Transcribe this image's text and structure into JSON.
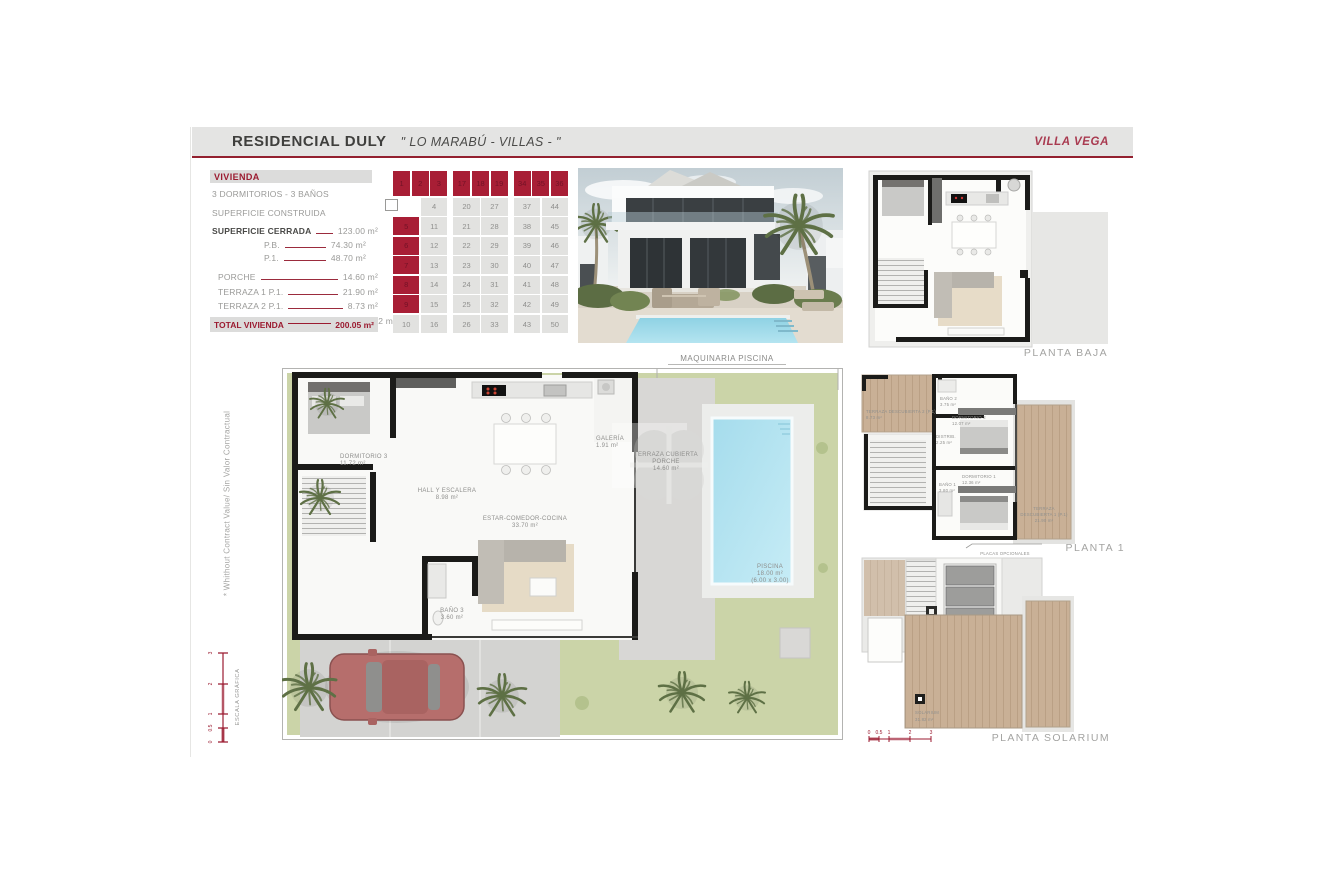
{
  "header": {
    "title": "RESIDENCIAL DULY",
    "subtitle": "\" LO MARABÚ - VILLAS - \"",
    "villa": "VILLA VEGA"
  },
  "specs": {
    "section_title": "VIVIENDA",
    "line1": "3 DORMITORIOS - 3 BAÑOS",
    "line2": "SUPERFICIE CONSTRUIDA",
    "rows": [
      {
        "label": "SUPERFICIE CERRADA",
        "value": "123.00 m²",
        "style": "main"
      },
      {
        "label": "P.B.",
        "value": "74.30 m²",
        "style": "sub"
      },
      {
        "label": "P.1.",
        "value": "48.70 m²",
        "style": "sub"
      },
      {
        "label": "PORCHE",
        "value": "14.60 m²",
        "style": "plain gap"
      },
      {
        "label": "TERRAZA 1 P.1.",
        "value": "21.90 m²",
        "style": "plain"
      },
      {
        "label": "TERRAZA 2 P.1.",
        "value": "8.73 m²",
        "style": "plain"
      },
      {
        "label": "TERRAZA PLANTA SOLARIUM",
        "value": "31.82 m²",
        "style": "plain"
      }
    ],
    "total": {
      "label": "TOTAL VIVIENDA",
      "value": "200.05 m²"
    }
  },
  "plot_grid": {
    "blocks": [
      {
        "header": [
          "1",
          "2",
          "3"
        ],
        "rows": [
          [
            "",
            "4"
          ],
          [
            "5",
            "11"
          ],
          [
            "6",
            "12"
          ],
          [
            "7",
            "13"
          ],
          [
            "8",
            "14"
          ],
          [
            "9",
            "15"
          ],
          [
            "10",
            "16"
          ]
        ],
        "red_cells": [
          "5",
          "6",
          "7",
          "8",
          "9"
        ]
      },
      {
        "header": [
          "17",
          "18",
          "19"
        ],
        "rows": [
          [
            "20",
            "27"
          ],
          [
            "21",
            "28"
          ],
          [
            "22",
            "29"
          ],
          [
            "23",
            "30"
          ],
          [
            "24",
            "31"
          ],
          [
            "25",
            "32"
          ],
          [
            "26",
            "33"
          ]
        ],
        "red_cells": []
      },
      {
        "header": [
          "34",
          "35",
          "36"
        ],
        "rows": [
          [
            "37",
            "44"
          ],
          [
            "38",
            "45"
          ],
          [
            "39",
            "46"
          ],
          [
            "40",
            "47"
          ],
          [
            "41",
            "48"
          ],
          [
            "42",
            "49"
          ],
          [
            "43",
            "50"
          ]
        ],
        "red_cells": []
      }
    ]
  },
  "site_plan": {
    "top_label": "MAQUINARIA PISCINA",
    "rooms": [
      {
        "name": "DORMITORIO 3",
        "area": "11.72 m²"
      },
      {
        "name": "GALERÍA",
        "area": "1.91 m²"
      },
      {
        "name": "HALL Y ESCALERA",
        "area": "8.98 m²"
      },
      {
        "name": "ESTAR-COMEDOR-COCINA",
        "area": "33.70 m²"
      },
      {
        "name": "BAÑO 3",
        "area": "3.60 m²"
      },
      {
        "name": "TERRAZA CUBIERTA PORCHE",
        "lines": [
          "TERRAZA CUBIERTA",
          "PORCHE"
        ],
        "area": "14.60 m²"
      },
      {
        "name": "PISCINA",
        "area": "18.00 m²",
        "dims": "(6.00 x 3.00)"
      }
    ]
  },
  "floor_plans": {
    "planta_baja": {
      "label": "PLANTA BAJA"
    },
    "planta_1": {
      "label": "PLANTA 1",
      "note": "PLACAS OPCIONALES",
      "rooms": [
        {
          "name": "TERRAZA DESCUBIERTA 2 (P.1)",
          "area": "8.73 m²"
        },
        {
          "name": "BAÑO 2",
          "area": "3.75 m²"
        },
        {
          "name": "DORMITORIO 2",
          "area": "12.07 m²"
        },
        {
          "name": "DISTRIB.",
          "area": "2.25 m²"
        },
        {
          "name": "BAÑO 1",
          "area": "3.80 m²"
        },
        {
          "name": "DORMITORIO 1",
          "area": "12.36 m²"
        },
        {
          "name": "TERRAZA DESCUBIERTA 1 (P.1)",
          "lines": [
            "TERRAZA",
            "DESCUBIERTA 1 (P.1)"
          ],
          "area": "21.90 m²"
        }
      ]
    },
    "planta_solarium": {
      "label": "PLANTA SOLARIUM",
      "rooms": [
        {
          "name": "SOLARIUM",
          "area": "31.82 m²"
        }
      ]
    }
  },
  "footnote": "* Whithout Contract Value/ Sin Valor Contractual",
  "scale": {
    "label": "ESCALA GRÁFICA",
    "ticks": [
      "0",
      "0.5",
      "1",
      "2",
      "3"
    ]
  },
  "colors": {
    "brand_red": "#93202f",
    "cell_red": "#a81e35",
    "pool": "#aadfee",
    "lawn": "#cbd4a8",
    "wood": "#c9b096"
  }
}
